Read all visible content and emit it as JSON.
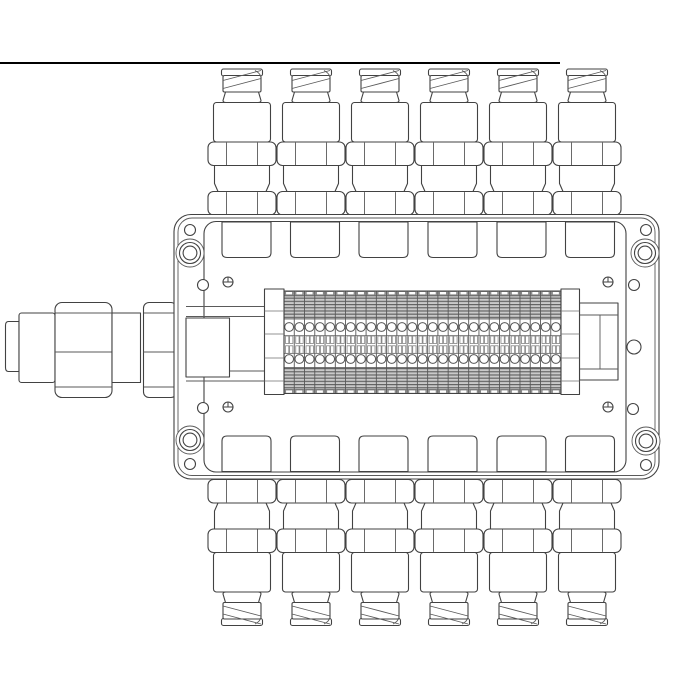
{
  "meta": {
    "description": "Monochrome technical line drawing of a rectangular junction box: six corrugated-conduit cable glands on the top edge, six on the bottom edge, one cable connector on the left side, and an internal 27-pole dual-row terminal strip",
    "background": "#ffffff",
    "line_color": "#424242",
    "rule_color": "#000000"
  },
  "top_rule": {
    "x": 0,
    "y": 62,
    "width": 560,
    "height": 2
  },
  "enclosure": {
    "outer": {
      "x": 174,
      "y": 214.5,
      "width": 485,
      "height": 264.5,
      "radius": 17
    },
    "second": {
      "x": 178,
      "y": 218,
      "width": 477,
      "height": 257.5,
      "radius": 14
    },
    "lid": {
      "x": 204,
      "y": 221.5,
      "width": 422,
      "height": 250.5,
      "radius": 12
    }
  },
  "glands": {
    "count_top": 6,
    "count_bottom": 6,
    "top_centers_x": [
      242,
      311,
      380,
      449,
      518,
      587
    ],
    "bottom_centers_x": [
      242,
      311,
      380,
      449,
      518,
      587
    ],
    "mirror_y": 694.5
  },
  "hubs": {
    "top_centers_x": [
      246.5,
      315,
      383.5,
      452.5,
      521.5,
      590
    ],
    "bottom_centers_x": [
      246.5,
      315,
      383.5,
      452.5,
      521.5,
      590
    ],
    "mirror_y": 693.5
  },
  "terminal_strip": {
    "x": 284,
    "y": 291,
    "width": 277,
    "height": 102.5,
    "cells": 27,
    "pitch": 10.26,
    "terminal_rows": 2,
    "terminals_per_row": 27,
    "left_bracket": {
      "x": 264.5,
      "y": 289,
      "width": 19.5,
      "height": 105.5
    },
    "right_bracket": {
      "x": 561,
      "y": 289,
      "width": 18.5,
      "height": 105.5
    },
    "bracket_line_ys": [
      311,
      334,
      358,
      381
    ]
  },
  "rails_left_ys": [
    306.5,
    316.5,
    371,
    381
  ],
  "holes": {
    "corner_rings": [
      [
        190,
        253
      ],
      [
        645,
        253
      ],
      [
        190,
        440
      ],
      [
        646,
        441
      ]
    ],
    "small": [
      [
        190,
        230
      ],
      [
        646,
        230
      ],
      [
        203,
        285
      ],
      [
        634,
        285
      ],
      [
        203,
        408
      ],
      [
        633,
        409
      ],
      [
        190,
        464
      ],
      [
        646,
        465
      ]
    ],
    "mid_right": [
      634,
      347
    ]
  },
  "lid_screws": [
    [
      228,
      282
    ],
    [
      608,
      282
    ],
    [
      228,
      407
    ],
    [
      608,
      407
    ]
  ]
}
